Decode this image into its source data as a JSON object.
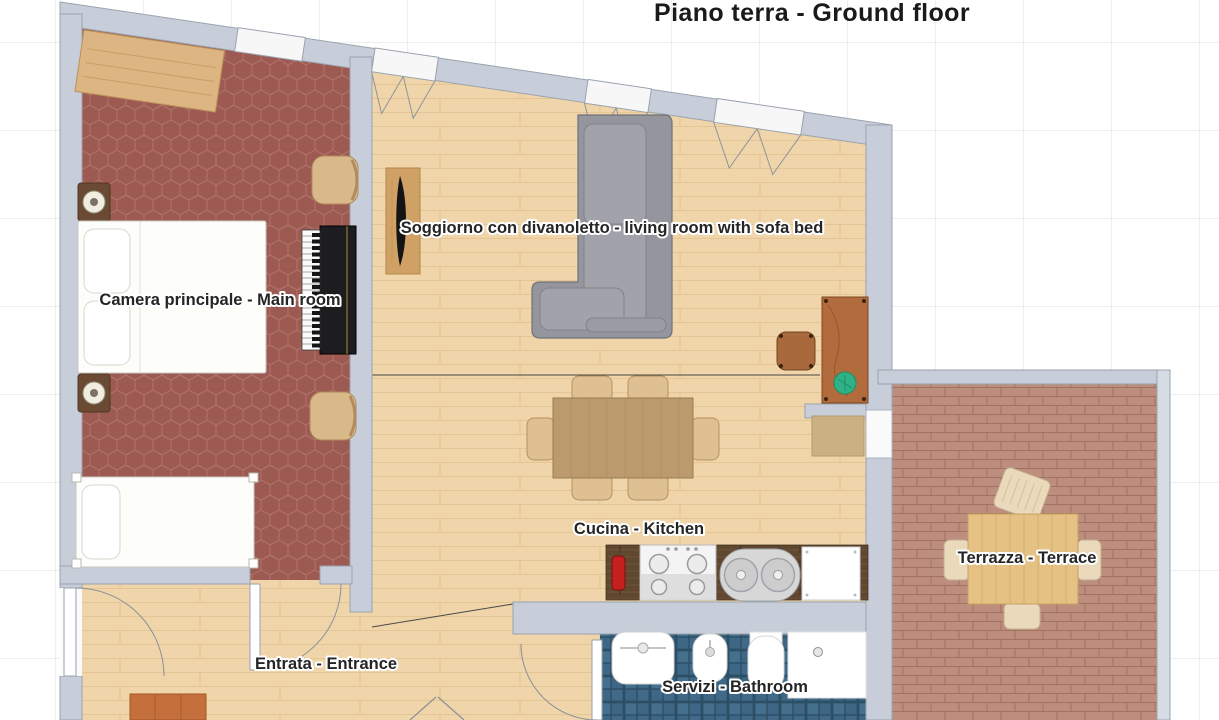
{
  "title": "Piano terra - Ground floor",
  "rooms": [
    {
      "name": "bedroom",
      "label": "Camera principale - Main room",
      "floor": "red hexagonal tiles"
    },
    {
      "name": "living-room",
      "label": "Soggiorno con divanoletto - living room with sofa bed",
      "floor": "light wood planks"
    },
    {
      "name": "kitchen",
      "label": "Cucina - Kitchen",
      "floor": "light wood planks"
    },
    {
      "name": "entrance",
      "label": "Entrata - Entrance",
      "floor": "light wood planks"
    },
    {
      "name": "bathroom",
      "label": "Servizi - Bathroom",
      "floor": "blue square tiles"
    },
    {
      "name": "terrace",
      "label": "Terrazza - Terrace",
      "floor": "terracotta bricks"
    }
  ],
  "furniture": [
    {
      "room": "bedroom",
      "items": [
        "dresser",
        "nightstand with lamp",
        "double bed",
        "nightstand with lamp",
        "upright piano",
        "chair",
        "chair",
        "single bed"
      ]
    },
    {
      "room": "living-room",
      "items": [
        "tv sideboard",
        "corner sofa bed",
        "desk",
        "desk chair",
        "plant"
      ]
    },
    {
      "room": "kitchen",
      "items": [
        "dining table",
        "six chairs",
        "kitchen counter",
        "fire extinguisher",
        "stove",
        "double sink",
        "dishwasher",
        "door mat"
      ]
    },
    {
      "room": "entrance",
      "items": [
        "shoe cabinet"
      ]
    },
    {
      "room": "bathroom",
      "items": [
        "washbasin",
        "bidet",
        "toilet",
        "shower"
      ]
    },
    {
      "room": "terrace",
      "items": [
        "outdoor table",
        "four chairs"
      ]
    }
  ],
  "openings": {
    "windows_on_top_wall": 4,
    "doors": [
      "entrance front door",
      "bedroom door",
      "bathroom door",
      "terrace door",
      "double door bottom"
    ]
  },
  "grid": {
    "cell_px": 88
  },
  "colors": {
    "wall": "#c7ceda",
    "wall_outline": "#9aa3ae",
    "wood_floor": "#efd5a9",
    "bedroom_floor": "#9d5a52",
    "bathroom_floor": "#3d6784",
    "terrace_floor": "#bd8e7e",
    "counter": "#5f4730",
    "sofa": "#95959d",
    "title_text": "#1a1a1a",
    "label_text": "#252525",
    "grid_line": "#d9dce1",
    "background": "#ffffff"
  }
}
